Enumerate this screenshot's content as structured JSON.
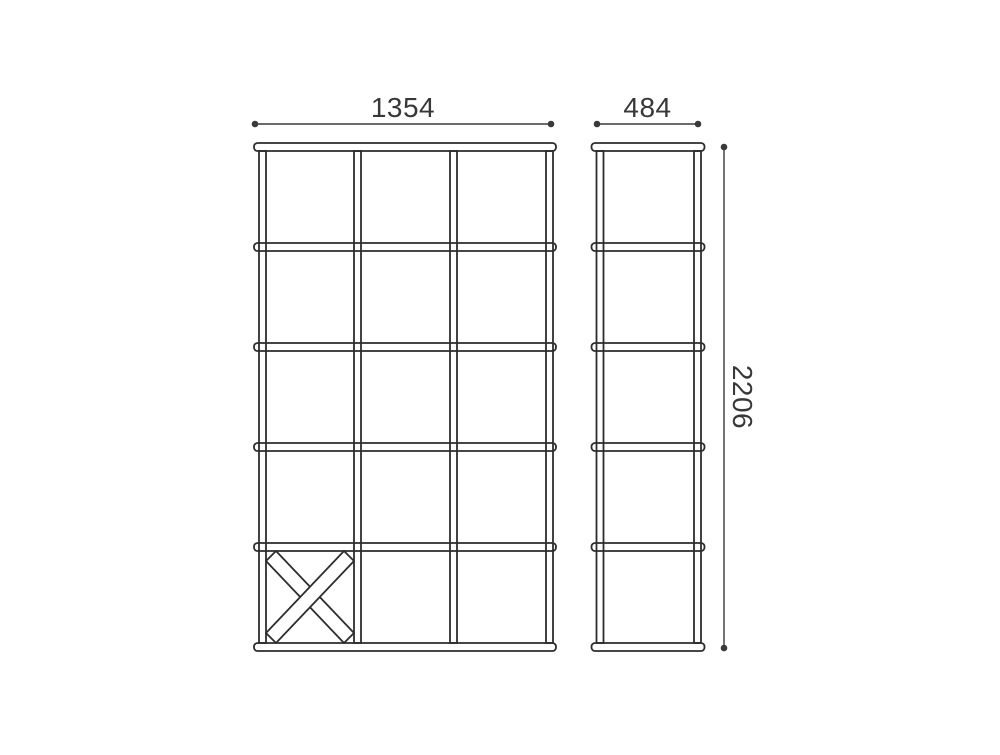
{
  "drawing": {
    "type": "furniture-dimension-diagram",
    "front_view": {
      "name": "front elevation of cube shelving unit",
      "width_label": "1354",
      "columns": 3,
      "rows": 5,
      "cross_brace_cell": "bottom-left"
    },
    "side_view": {
      "name": "side elevation of cube shelving unit",
      "depth_label": "484",
      "columns": 1,
      "rows": 5
    },
    "height_label": "2206",
    "colors": {
      "line": "#2d2d2d",
      "dimension": "#3a3a3a",
      "text": "#383838",
      "background": "#ffffff"
    }
  }
}
